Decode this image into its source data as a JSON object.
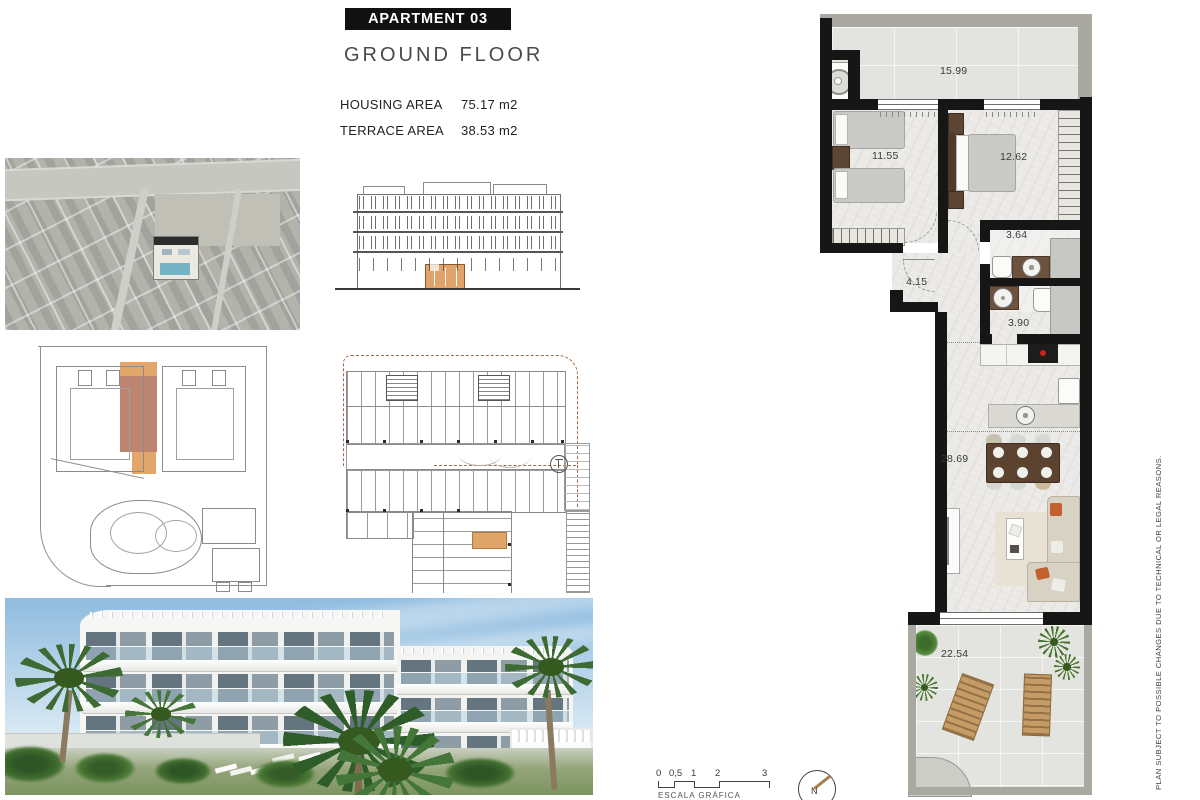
{
  "header": {
    "apartment_label": "APARTMENT 03",
    "floor_label": "GROUND FLOOR",
    "housing_area_label": "HOUSING AREA",
    "housing_area_value": "75.17 m2",
    "terrace_area_label": "TERRACE AREA",
    "terrace_area_value": "38.53 m2"
  },
  "floor_plan": {
    "rooms": [
      {
        "name": "terrace-top",
        "area": "15.99"
      },
      {
        "name": "bedroom-1",
        "area": "11.55"
      },
      {
        "name": "bedroom-2",
        "area": "12.62"
      },
      {
        "name": "bathroom-1",
        "area": "3.64"
      },
      {
        "name": "entrance-hall",
        "area": "4.15"
      },
      {
        "name": "bathroom-2",
        "area": "3.90"
      },
      {
        "name": "living-kitchen",
        "area": "28.69"
      },
      {
        "name": "terrace-bottom",
        "area": "22.54"
      }
    ]
  },
  "scale_bar": {
    "ticks": [
      "0",
      "0,5",
      "1",
      "2",
      "3"
    ],
    "caption": "ESCALA GRÁFICA"
  },
  "compass": {
    "north_label": "N"
  },
  "disclaimer": "PLAN SUBJECT TO POSSIBLE CHANGES DUE TO TECHNICAL OR LEGAL REASONS.",
  "colors": {
    "wall_black": "#161616",
    "highlight_salmon": "#bd8470",
    "highlight_tan": "#e2a66b",
    "cooktop_red": "#cc2218",
    "pool_blue": "#76b4c6"
  }
}
